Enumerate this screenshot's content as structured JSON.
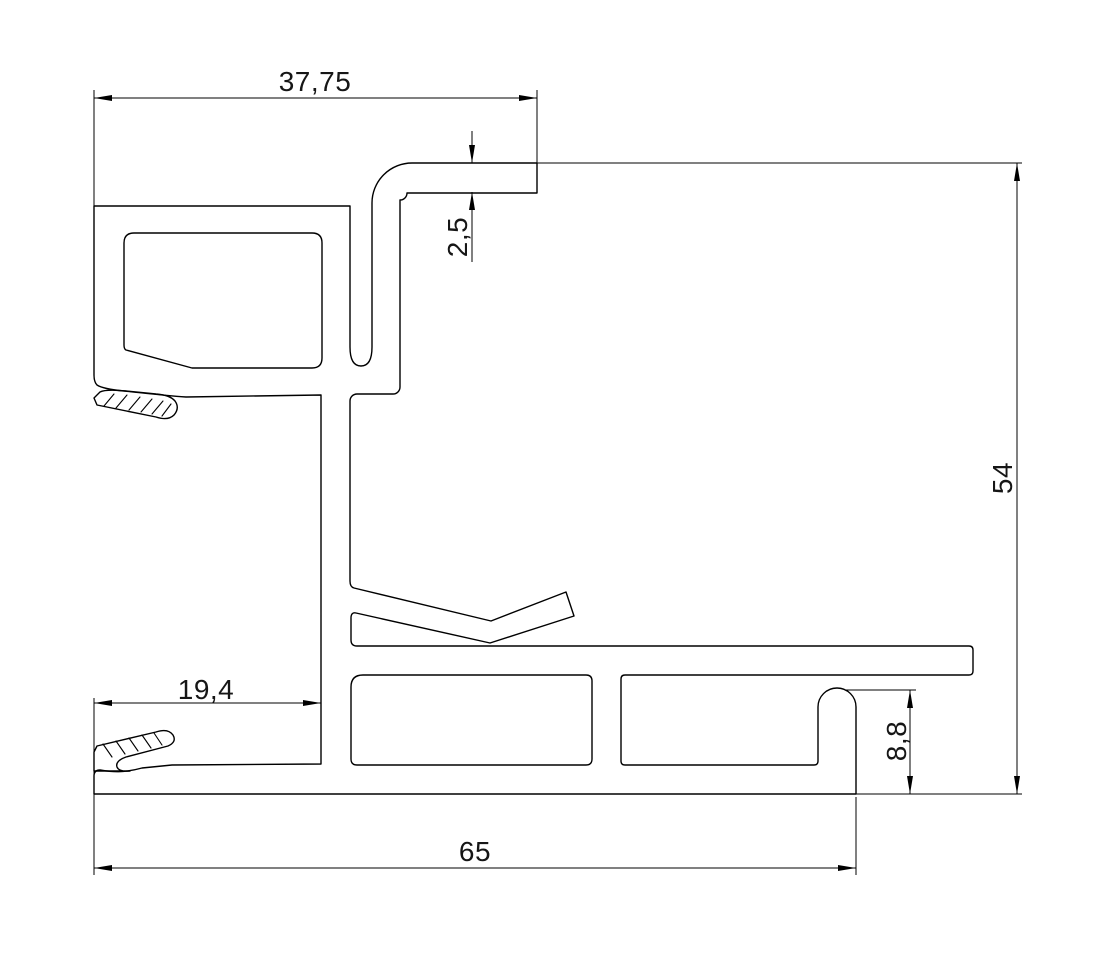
{
  "drawing": {
    "type": "technical-profile-cross-section",
    "description": "CAD cross-section drawing of an aluminium extrusion profile with glazing flap, gasket barbs and snap hook, annotated with linear dimensions",
    "background_color": "#ffffff",
    "line_color": "#000000",
    "dimensions": {
      "top_width": "37,75",
      "lip_thickness": "2,5",
      "overall_height": "54",
      "left_offset": "19,4",
      "hook_height": "8,8",
      "overall_width": "65"
    }
  }
}
